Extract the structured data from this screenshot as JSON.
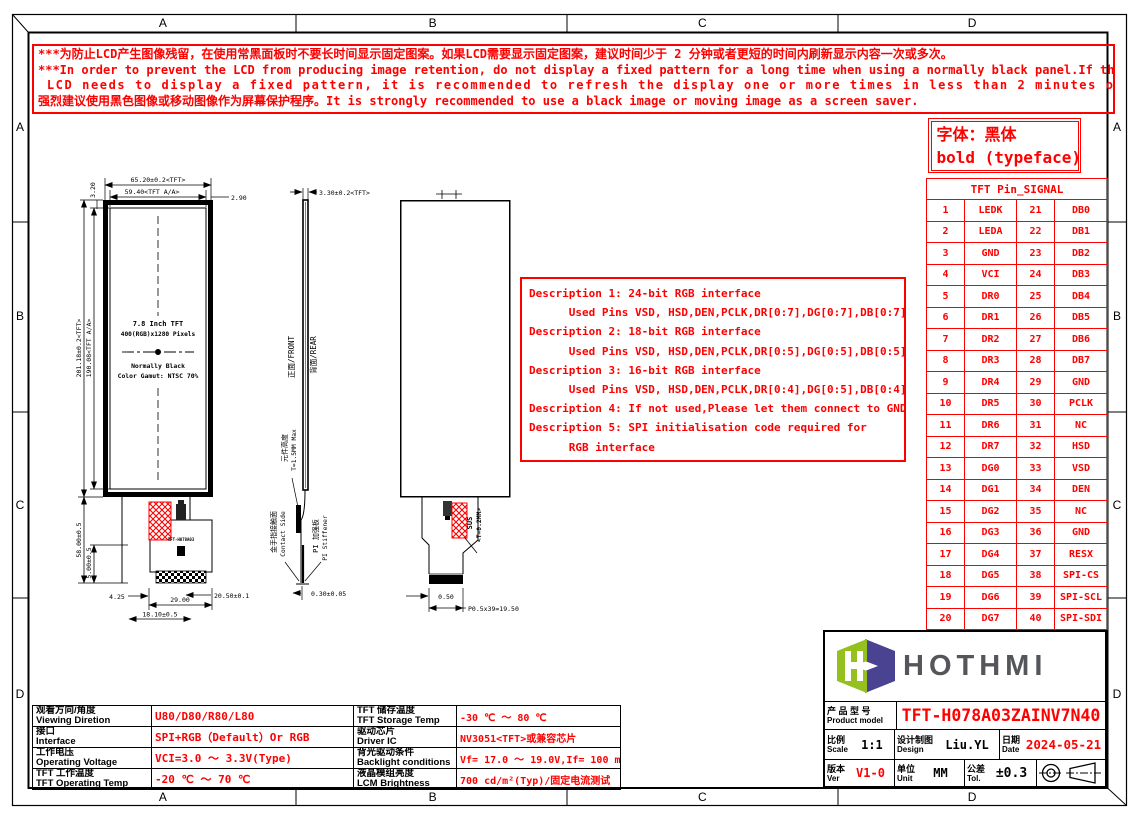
{
  "meta": {
    "colors": {
      "red": "#fe0000",
      "line_black": "#000000",
      "logo_green": "#95c11f",
      "logo_purple": "#4a4391",
      "logo_text_gray": "#55565a"
    }
  },
  "frame": {
    "cols": [
      "A",
      "B",
      "C",
      "D"
    ],
    "rows": [
      "A",
      "B",
      "C",
      "D"
    ]
  },
  "warning": {
    "lines": [
      "***为防止LCD产生图像残留，在使用常黑面板时不要长时间显示固定图案。如果LCD需要显示固定图案，建议时间少于 2 分钟或者更短的时间内刷新显示内容一次或多次。",
      "***In order to prevent the LCD from producing image retention, do not display a fixed pattern for a long time when using a normally black panel.If the",
      " LCD needs to display a fixed pattern, it is recommended to refresh the display one or more times in less than 2 minutes or less.",
      "强烈建议使用黑色图像或移动图像作为屏幕保护程序。It is strongly recommended to use a black image or moving image as a screen saver."
    ]
  },
  "typeface_note": {
    "line1": "字体：黑体",
    "line2": "bold (typeface)"
  },
  "pin_table": {
    "title": "TFT Pin_SIGNAL",
    "rows": [
      [
        "1",
        "LEDK",
        "21",
        "DB0"
      ],
      [
        "2",
        "LEDA",
        "22",
        "DB1"
      ],
      [
        "3",
        "GND",
        "23",
        "DB2"
      ],
      [
        "4",
        "VCI",
        "24",
        "DB3"
      ],
      [
        "5",
        "DR0",
        "25",
        "DB4"
      ],
      [
        "6",
        "DR1",
        "26",
        "DB5"
      ],
      [
        "7",
        "DR2",
        "27",
        "DB6"
      ],
      [
        "8",
        "DR3",
        "28",
        "DB7"
      ],
      [
        "9",
        "DR4",
        "29",
        "GND"
      ],
      [
        "10",
        "DR5",
        "30",
        "PCLK"
      ],
      [
        "11",
        "DR6",
        "31",
        "NC"
      ],
      [
        "12",
        "DR7",
        "32",
        "HSD"
      ],
      [
        "13",
        "DG0",
        "33",
        "VSD"
      ],
      [
        "14",
        "DG1",
        "34",
        "DEN"
      ],
      [
        "15",
        "DG2",
        "35",
        "NC"
      ],
      [
        "16",
        "DG3",
        "36",
        "GND"
      ],
      [
        "17",
        "DG4",
        "37",
        "RESX"
      ],
      [
        "18",
        "DG5",
        "38",
        "SPI-CS"
      ],
      [
        "19",
        "DG6",
        "39",
        "SPI-SCL"
      ],
      [
        "20",
        "DG7",
        "40",
        "SPI-SDI"
      ]
    ]
  },
  "descriptions": {
    "lines": [
      "Description 1: 24-bit RGB interface",
      "      Used Pins VSD, HSD,DEN,PCLK,DR[0:7],DG[0:7],DB[0:7]",
      "Description 2: 18-bit RGB interface",
      "      Used Pins VSD, HSD,DEN,PCLK,DR[0:5],DG[0:5],DB[0:5]",
      "Description 3: 16-bit RGB interface",
      "      Used Pins VSD, HSD,DEN,PCLK,DR[0:4],DG[0:5],DB[0:4]",
      "Description 4: If not used,Please let them connect to GND",
      "Description 5: SPI initialisation code required for",
      "      RGB interface"
    ]
  },
  "drawing": {
    "front": {
      "dim_width": "65.20±0.2<TFT>",
      "dim_width_aa": "59.40<TFT A/A>",
      "dim_right": "2.90",
      "dim_top_left": "3.20",
      "dim_height": "201.18±0.2<TFT>",
      "dim_height_aa": "190.08<TFT A/A>",
      "screen_line1": "7.8 Inch TFT",
      "screen_line2": "400(RGB)x1280 Pixels",
      "screen_line3": "Normally Black",
      "screen_line4": "Color Gamut: NTSC 70%",
      "dim_tail_height": "58.00±0.5",
      "dim_tail_offset": "5.00±0.5",
      "dim_425": "4.25",
      "dim_2900": "29.00",
      "dim_1810": "18.10±0.5",
      "dim_2050": "20.50±0.1",
      "fpc_text": "TFT-H078A03"
    },
    "side": {
      "dim_thickness": "3.30±0.2<TFT>",
      "front_face": "正面/FRONT",
      "rear_face": "背面/REAR",
      "component_cn": "元件高度",
      "component_en": "T=1.5MM Max",
      "contact_cn": "金手指接触面",
      "contact_en": "Contact Side",
      "stiffener_cn": "PI 加强板",
      "stiffener_en": "PI Stiffener",
      "dim_030": "0.30±0.05"
    },
    "rear": {
      "sus": "SUS",
      "sus_t": "<T=0.2MM>",
      "dim_050": "0.50",
      "dim_pitch": "P0.5x39=19.50"
    }
  },
  "spec_table": {
    "left": [
      {
        "cn": "观看方向/角度",
        "en": "Viewing Diretion",
        "value": "U80/D80/R80/L80"
      },
      {
        "cn": "接口",
        "en": "Interface",
        "value": "SPI+RGB（Default）Or RGB"
      },
      {
        "cn": "工作电压",
        "en": "Operating Voltage",
        "value": "VCI=3.0 ～ 3.3V(Type)"
      },
      {
        "cn": "TFT 工作温度",
        "en": "TFT Operating Temp",
        "value": "-20 ℃ ～ 70 ℃"
      }
    ],
    "right": [
      {
        "cn": "TFT 储存温度",
        "en": "TFT Storage Temp",
        "value": "-30 ℃ ～ 80 ℃"
      },
      {
        "cn": "驱动芯片",
        "en": "Driver IC",
        "value": "NV3051<TFT>或兼容芯片"
      },
      {
        "cn": "背光驱动条件",
        "en": "Backlight conditions",
        "value": "Vf= 17.0 ～ 19.0V,If= 100 mA"
      },
      {
        "cn": "液晶模组亮度",
        "en": "LCM Brightness",
        "value": "700 cd/m²(Typ)/固定电流测试"
      }
    ]
  },
  "title_block": {
    "logo_text": "HOTHMI",
    "product_label_cn": "产 品 型 号",
    "product_label_en": "Product model",
    "product_value": "TFT-H078A03ZAINV7N40",
    "scale_cn": "比例",
    "scale_en": "Scale",
    "scale_value": "1:1",
    "design_cn": "设计制图",
    "design_en": "Design",
    "design_value": "Liu.YL",
    "date_cn": "日期",
    "date_en": "Date",
    "date_value": "2024-05-21",
    "ver_cn": "版本",
    "ver_en": "Ver",
    "ver_value": "V1-0",
    "unit_cn": "单位",
    "unit_en": "Unit",
    "unit_value": "MM",
    "tol_cn": "公差",
    "tol_en": "Tol.",
    "tol_value": "±0.3"
  }
}
